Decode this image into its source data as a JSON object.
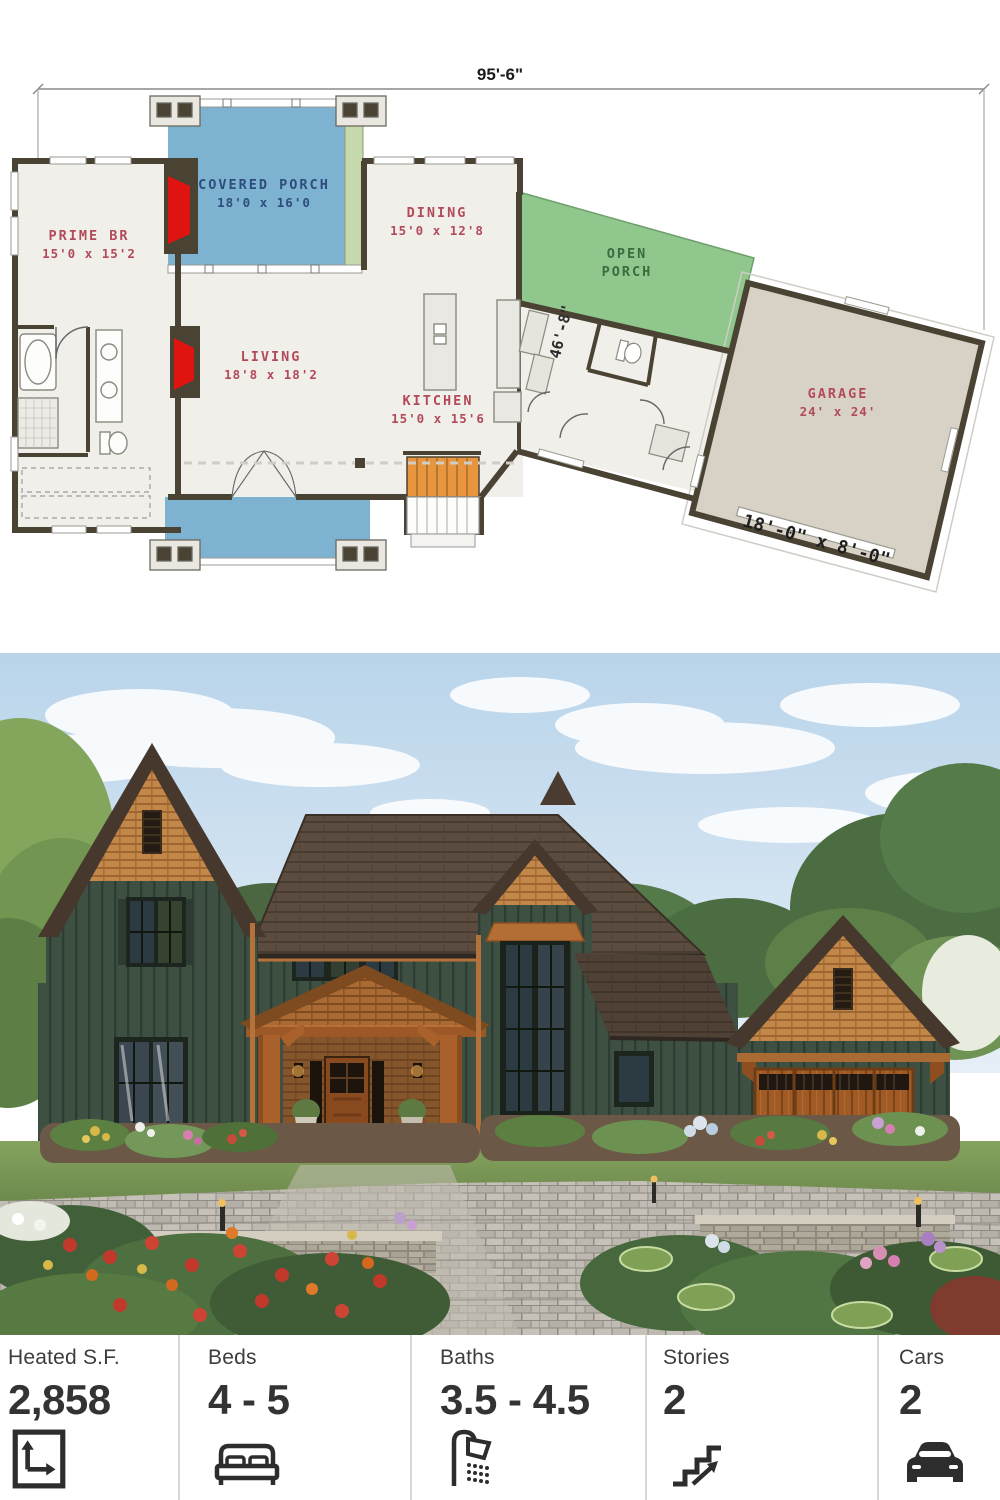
{
  "plan": {
    "overall_width": "95'-6\"",
    "depth": "46'-8\"",
    "garage_door": "18'-0\" x 8'-0\"",
    "rooms": {
      "covered_porch": {
        "name": "COVERED PORCH",
        "dims": "18'0 x 16'0"
      },
      "prime_br": {
        "name": "PRIME BR",
        "dims": "15'0 x 15'2"
      },
      "dining": {
        "name": "DINING",
        "dims": "15'0 x 12'8"
      },
      "living": {
        "name": "LIVING",
        "dims": "18'8 x 18'2"
      },
      "kitchen": {
        "name": "KITCHEN",
        "dims": "15'0 x 15'6"
      },
      "open_porch": {
        "line1": "OPEN",
        "line2": "PORCH"
      },
      "garage": {
        "name": "GARAGE",
        "dims": "24' x 24'"
      }
    }
  },
  "stats": {
    "items": [
      {
        "label": "Heated S.F.",
        "value": "2,858",
        "icon": "floor-area-icon"
      },
      {
        "label": "Beds",
        "value": "4 - 5",
        "icon": "bed-icon"
      },
      {
        "label": "Baths",
        "value": "3.5 - 4.5",
        "icon": "shower-icon"
      },
      {
        "label": "Stories",
        "value": "2",
        "icon": "stairs-icon"
      },
      {
        "label": "Cars",
        "value": "2",
        "icon": "car-icon"
      }
    ]
  },
  "colors": {
    "porch_blue": "#7eb2d1",
    "open_porch_green": "#8fc78d",
    "garage_fill": "#d8d2c6",
    "stairs_orange": "#e8953f",
    "wall_dark": "#4a4334",
    "accent_red": "#df1410",
    "label_red": "#b24a5a",
    "label_navy": "#2e4d7c",
    "label_green": "#3c6b3f",
    "house_green": "#3e5042",
    "cedar_brown": "#c3874a",
    "roof_brown": "#5b4c3f"
  }
}
